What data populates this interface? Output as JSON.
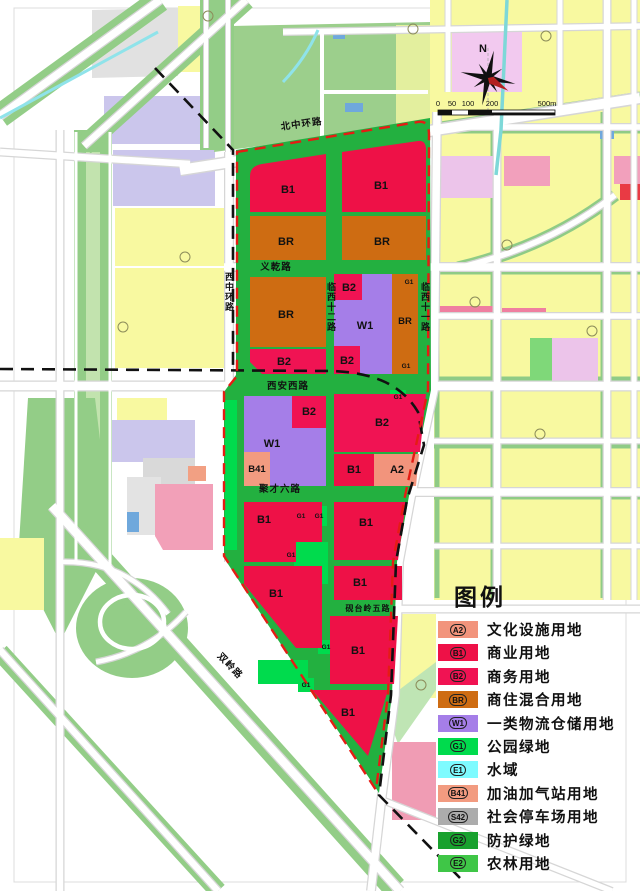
{
  "legend": {
    "title": "图例",
    "items": [
      {
        "code": "A2",
        "label": "文化设施用地",
        "color": "#F2947C"
      },
      {
        "code": "B1",
        "label": "商业用地",
        "color": "#EE1147"
      },
      {
        "code": "B2",
        "label": "商务用地",
        "color": "#F01353"
      },
      {
        "code": "BR",
        "label": "商住混合用地",
        "color": "#CE6C12"
      },
      {
        "code": "W1",
        "label": "一类物流仓储用地",
        "color": "#A57EE8"
      },
      {
        "code": "G1",
        "label": "公园绿地",
        "color": "#00DB4D"
      },
      {
        "code": "E1",
        "label": "水域",
        "color": "#7EFBFF"
      },
      {
        "code": "B41",
        "label": "加油加气站用地",
        "color": "#F29B80"
      },
      {
        "code": "S42",
        "label": "社会停车场用地",
        "color": "#ACACAC"
      },
      {
        "code": "G2",
        "label": "防护绿地",
        "color": "#18A12E"
      },
      {
        "code": "E2",
        "label": "农林用地",
        "color": "#3FC647"
      }
    ]
  },
  "compass": {
    "north_label": "N"
  },
  "scale_bar": {
    "ticks": [
      "0",
      "50",
      "100",
      "200",
      "500m"
    ]
  },
  "roads": {
    "north_ring": "北中环路",
    "west_ring": "西中环路",
    "yiqian": "义乾路",
    "linxi12": "临西十二路",
    "linxi11": "临西十一路",
    "xian_west": "西安西路",
    "jucai6": "聚才六路",
    "yantai5": "砚台岭五路",
    "shuangling": "双岭路"
  },
  "codes": {
    "B1": "B1",
    "B2": "B2",
    "BR": "BR",
    "W1": "W1",
    "A2": "A2",
    "B41": "B41",
    "G1": "G1"
  }
}
